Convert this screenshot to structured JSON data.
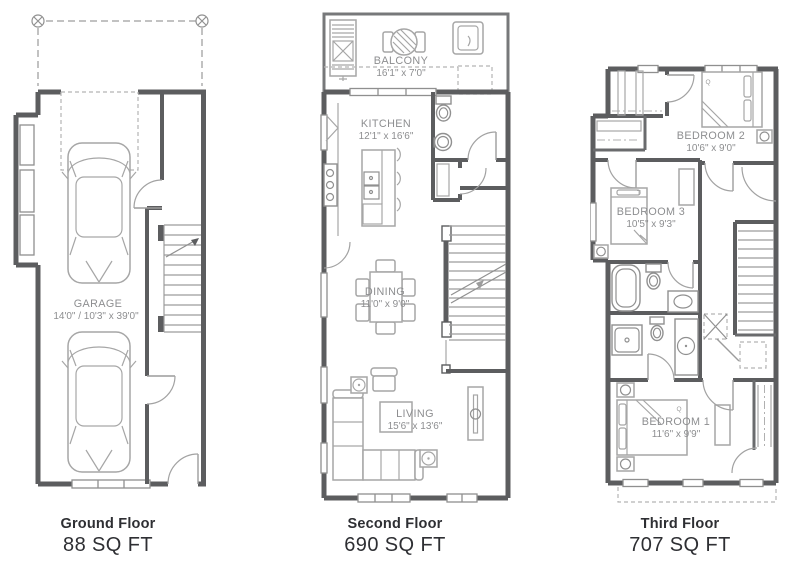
{
  "document": {
    "type": "townhouse-floor-plan-sheet"
  },
  "colors": {
    "wall": "#5c5d5f",
    "furniture_stroke": "#a6a6a6",
    "fixture_stroke": "#909090",
    "room_label": "#8d8e90",
    "dashed_line": "#adadad",
    "title_text": "#2e2f33",
    "background": "#ffffff"
  },
  "floors": [
    {
      "id": "ground",
      "title": "Ground Floor",
      "area": "88 SQ FT",
      "rooms": [
        {
          "name": "GARAGE",
          "dims": "14'0\" / 10'3\" x 39'0\""
        }
      ]
    },
    {
      "id": "second",
      "title": "Second Floor",
      "area": "690 SQ FT",
      "rooms": [
        {
          "name": "BALCONY",
          "dims": "16'1\" x 7'0\""
        },
        {
          "name": "KITCHEN",
          "dims": "12'1\" x 16'6\""
        },
        {
          "name": "DINING",
          "dims": "11'0\" x 9'0\""
        },
        {
          "name": "LIVING",
          "dims": "15'6\" x 13'6\""
        }
      ]
    },
    {
      "id": "third",
      "title": "Third Floor",
      "area": "707 SQ FT",
      "rooms": [
        {
          "name": "BEDROOM 2",
          "dims": "10'6\" x 9'0\""
        },
        {
          "name": "BEDROOM 3",
          "dims": "10'5\" x 9'3\""
        },
        {
          "name": "BEDROOM 1",
          "dims": "11'6\" x 9'9\""
        }
      ],
      "beds": [
        {
          "room": "BEDROOM 2",
          "size_tag": "Q"
        },
        {
          "room": "BEDROOM 3",
          "size_tag": "T"
        },
        {
          "room": "BEDROOM 1",
          "size_tag": "Q"
        }
      ]
    }
  ]
}
